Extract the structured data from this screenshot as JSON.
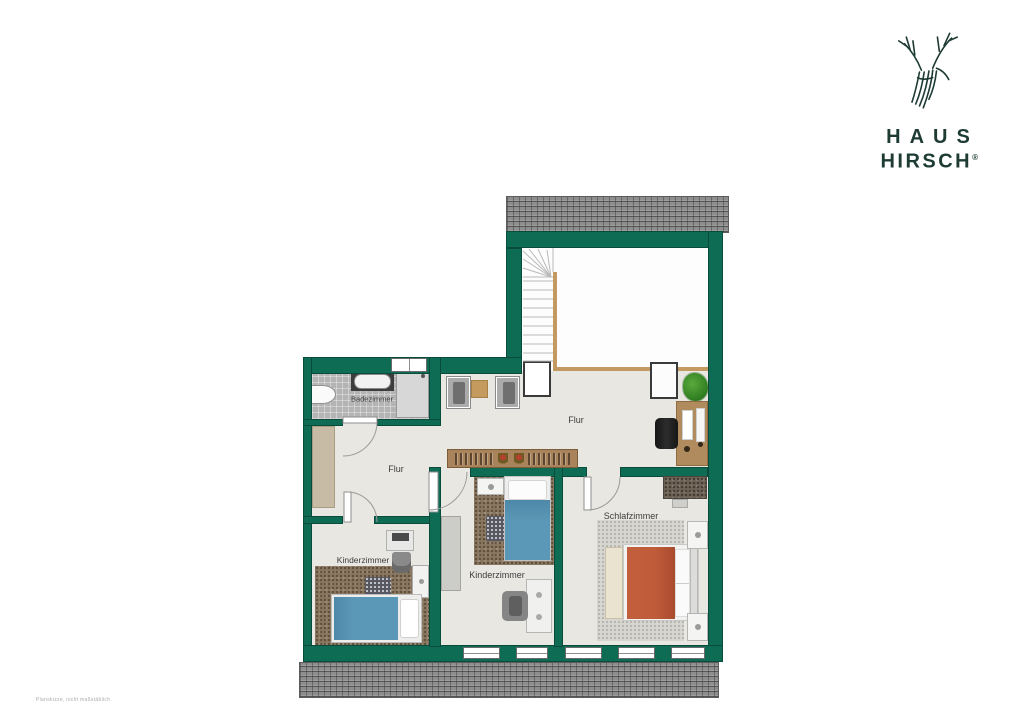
{
  "brand": {
    "line1": "HAUS",
    "line2": "HIRSCH",
    "registered_mark": "®",
    "logo_icon": "deer-head-sketch"
  },
  "watermark": "Planskizze, nicht maßstäblich",
  "floorplan": {
    "rooms": {
      "badezimmer": {
        "label": "Badezimmer"
      },
      "flur_left": {
        "label": "Flur"
      },
      "flur_main": {
        "label": "Flur"
      },
      "kinderzimmer_left": {
        "label": "Kinderzimmer"
      },
      "kinderzimmer_mid": {
        "label": "Kinderzimmer"
      },
      "schlafzimmer": {
        "label": "Schlafzimmer"
      }
    },
    "features": [
      "staircase",
      "roof-hatch-top",
      "roof-hatch-bottom",
      "windows",
      "door-swings",
      "knee-wall-edge"
    ],
    "furniture": [
      "bathtub",
      "washbasin",
      "shower",
      "hall-closet",
      "armchair",
      "armchair",
      "side-table",
      "stair-landing",
      "hall-dresser",
      "plant",
      "desk",
      "office-chair",
      "sideboard-with-books",
      "single-bed-blue",
      "single-bed-blue",
      "double-bed-red",
      "bed-bench",
      "nightstand",
      "nightstand",
      "rug",
      "rug",
      "children-desk",
      "children-desk",
      "desk-chair",
      "desk-chair",
      "wardrobe",
      "wardrobe-gray",
      "dresser"
    ]
  },
  "colors": {
    "wall": "#0E6C54",
    "wall-edge": "#0A4C3B",
    "floor": "#E9E7E2",
    "floor-white": "#FDFDFD",
    "roof": "#8E8E8E",
    "carpet-brown": "#8A7760",
    "carpet-gray": "#D8D6D0",
    "beige": "#C7BBA5",
    "wood": "#B08B5D",
    "bed-blue": "#5B97B6",
    "bed-red": "#BF5B39",
    "brand": "#1E3B34"
  }
}
